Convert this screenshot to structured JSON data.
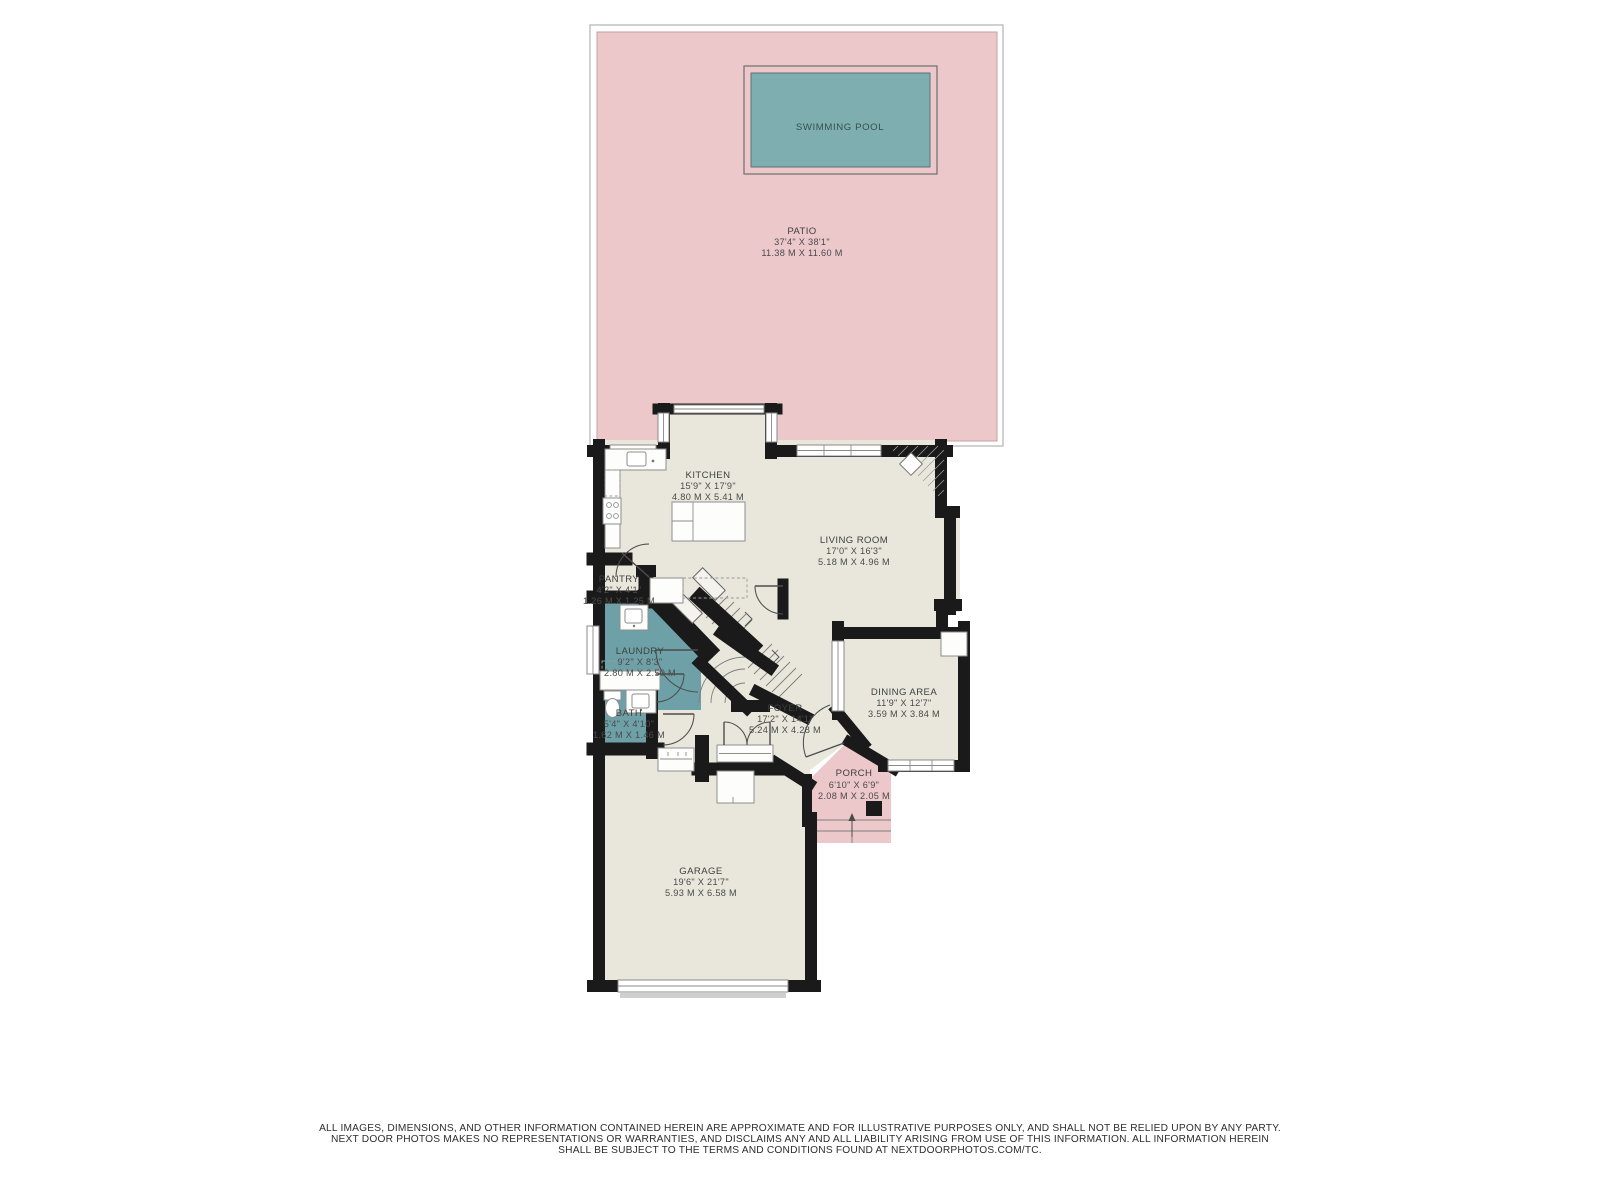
{
  "patio": {
    "name": "PATIO",
    "imperial": "37'4\" X 38'1\"",
    "metric": "11.38 M X 11.60 M"
  },
  "pool": {
    "name": "SWIMMING POOL"
  },
  "rooms": {
    "kitchen": {
      "name": "KITCHEN",
      "imperial": "15'9\" X 17'9\"",
      "metric": "4.80 M X 5.41 M"
    },
    "living_room": {
      "name": "LIVING ROOM",
      "imperial": "17'0\" X 16'3\"",
      "metric": "5.18 M X 4.96 M"
    },
    "pantry": {
      "name": "PANTRY",
      "imperial": "4'2\" X 4'1\"",
      "metric": "1.26 M X 1.25 M"
    },
    "laundry": {
      "name": "LAUNDRY",
      "imperial": "9'2\" X 8'3\"",
      "metric": "2.80 M X 2.50 M"
    },
    "bath": {
      "name": "BATH",
      "imperial": "5'4\" X 4'10\"",
      "metric": "1.62 M X 1.46 M"
    },
    "foyer": {
      "name": "FOYER",
      "imperial": "17'2\" X 14'1\"",
      "metric": "5.24 M X 4.28 M"
    },
    "dining_area": {
      "name": "DINING AREA",
      "imperial": "11'9\" X 12'7\"",
      "metric": "3.59 M X 3.84 M"
    },
    "porch": {
      "name": "PORCH",
      "imperial": "6'10\" X 6'9\"",
      "metric": "2.08 M X 2.05 M"
    },
    "garage": {
      "name": "GARAGE",
      "imperial": "19'6\" X 21'7\"",
      "metric": "5.93 M X 6.58 M"
    }
  },
  "disclaimer": {
    "line1": "ALL IMAGES, DIMENSIONS, AND OTHER INFORMATION CONTAINED HEREIN ARE APPROXIMATE AND FOR ILLUSTRATIVE PURPOSES ONLY, AND SHALL NOT BE RELIED UPON BY ANY PARTY.",
    "line2": "NEXT DOOR PHOTOS MAKES NO REPRESENTATIONS OR WARRANTIES, AND DISCLAIMS ANY AND ALL LIABILITY ARISING FROM USE OF THIS INFORMATION. ALL INFORMATION HEREIN",
    "line3": "SHALL BE SUBJECT TO THE TERMS AND CONDITIONS FOUND AT NEXTDOORPHOTOS.COM/TC."
  },
  "colors": {
    "patio-pink": "#edc8cb",
    "pool-teal": "#7faeb1",
    "wet-teal": "#6da1a7",
    "floor": "#e9e7dc",
    "wall": "#1a1a1a"
  }
}
